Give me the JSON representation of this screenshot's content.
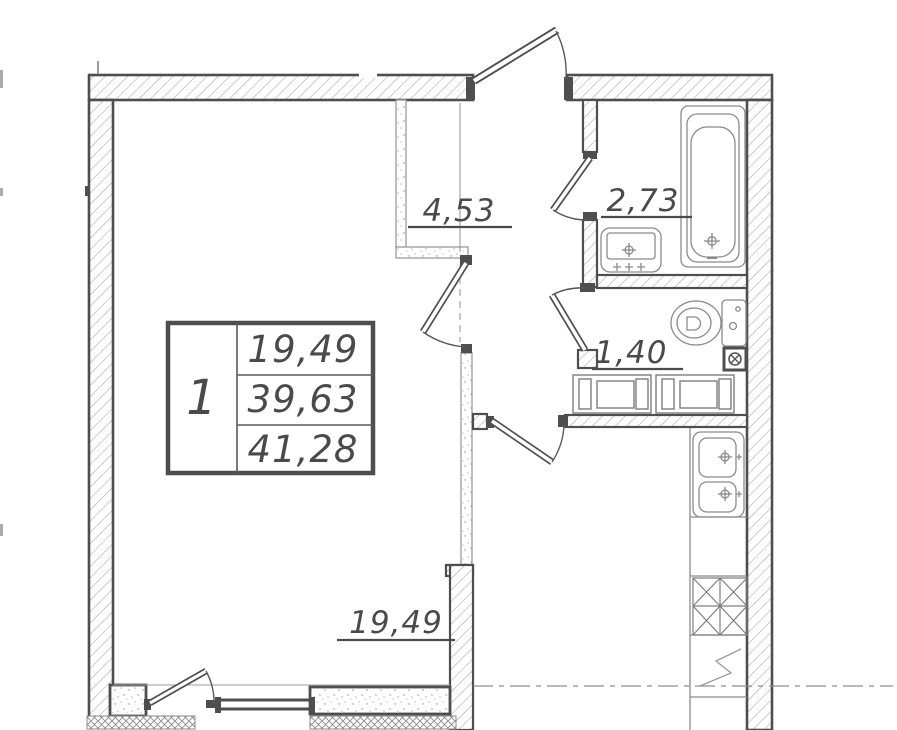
{
  "legend_table": {
    "unit_number": "1",
    "values": [
      "19,49",
      "39,63",
      "41,28"
    ]
  },
  "room_areas": [
    {
      "room": "hall",
      "area": "4,53"
    },
    {
      "room": "bathroom",
      "area": "2,73"
    },
    {
      "room": "wc",
      "area": "1,40"
    },
    {
      "room": "living-room",
      "area": "19,49"
    }
  ],
  "colors": {
    "wall_line": "#4e4e4e",
    "hatch_line": "#a6a6a6",
    "fixture_line": "#8a8a8a",
    "text": "#4a4a4a",
    "background": "#ffffff"
  }
}
